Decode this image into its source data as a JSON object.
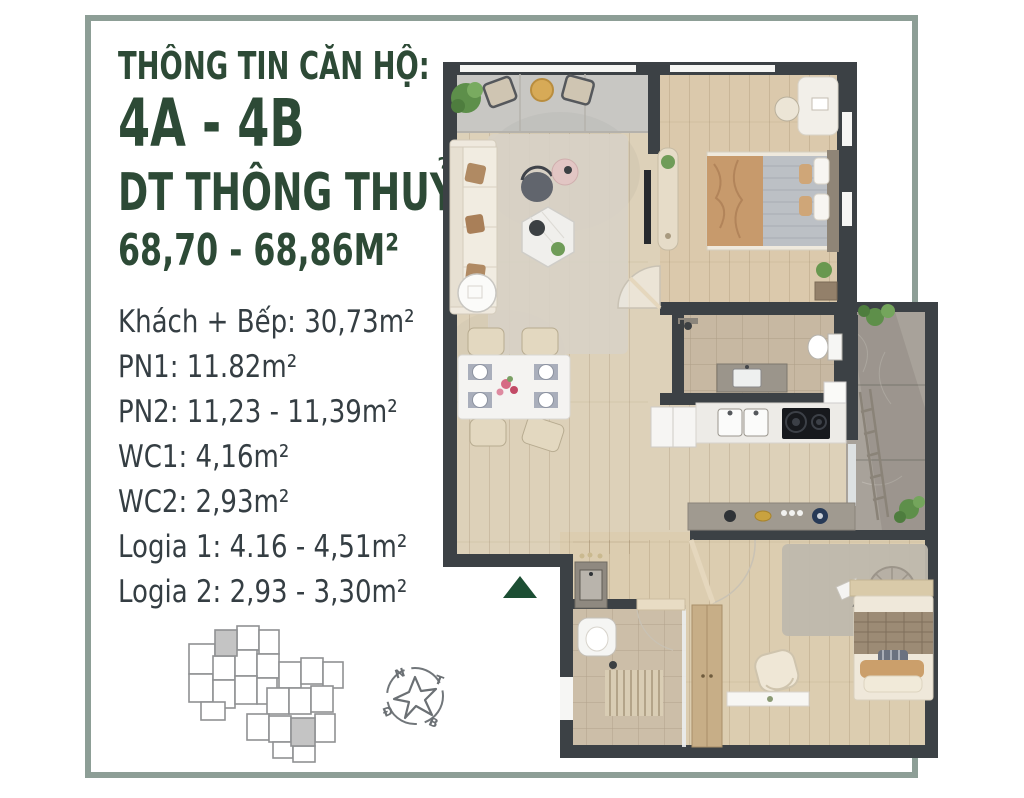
{
  "header": {
    "title": "THÔNG TIN CĂN HỘ:",
    "unit_name": "4A - 4B",
    "area_type_label": "DT THÔNG THUỶ",
    "area_range": "68,70 - 68,86M²"
  },
  "room_areas": [
    "Khách + Bếp: 30,73m²",
    "PN1: 11.82m²",
    "PN2: 11,23 - 11,39m²",
    "WC1: 4,16m²",
    "WC2: 2,93m²",
    "Logia 1: 4.16 - 4,51m²",
    "Logia 2: 2,93 - 3,30m²"
  ],
  "compass": {
    "top_left": "N",
    "top_right": "T",
    "bottom_left": "Đ",
    "bottom_right": "B"
  },
  "colors": {
    "heading_green": "#2d4a36",
    "body_text": "#353e43",
    "frame_border": "#8d9e96",
    "entrance_marker_green": "#1c4e33",
    "wall_dark": "#3c4145",
    "floor_wood": "#ddd0b5",
    "balcony_stone": "#a8a29a",
    "keyplan_highlight": "#c4c4c4"
  }
}
